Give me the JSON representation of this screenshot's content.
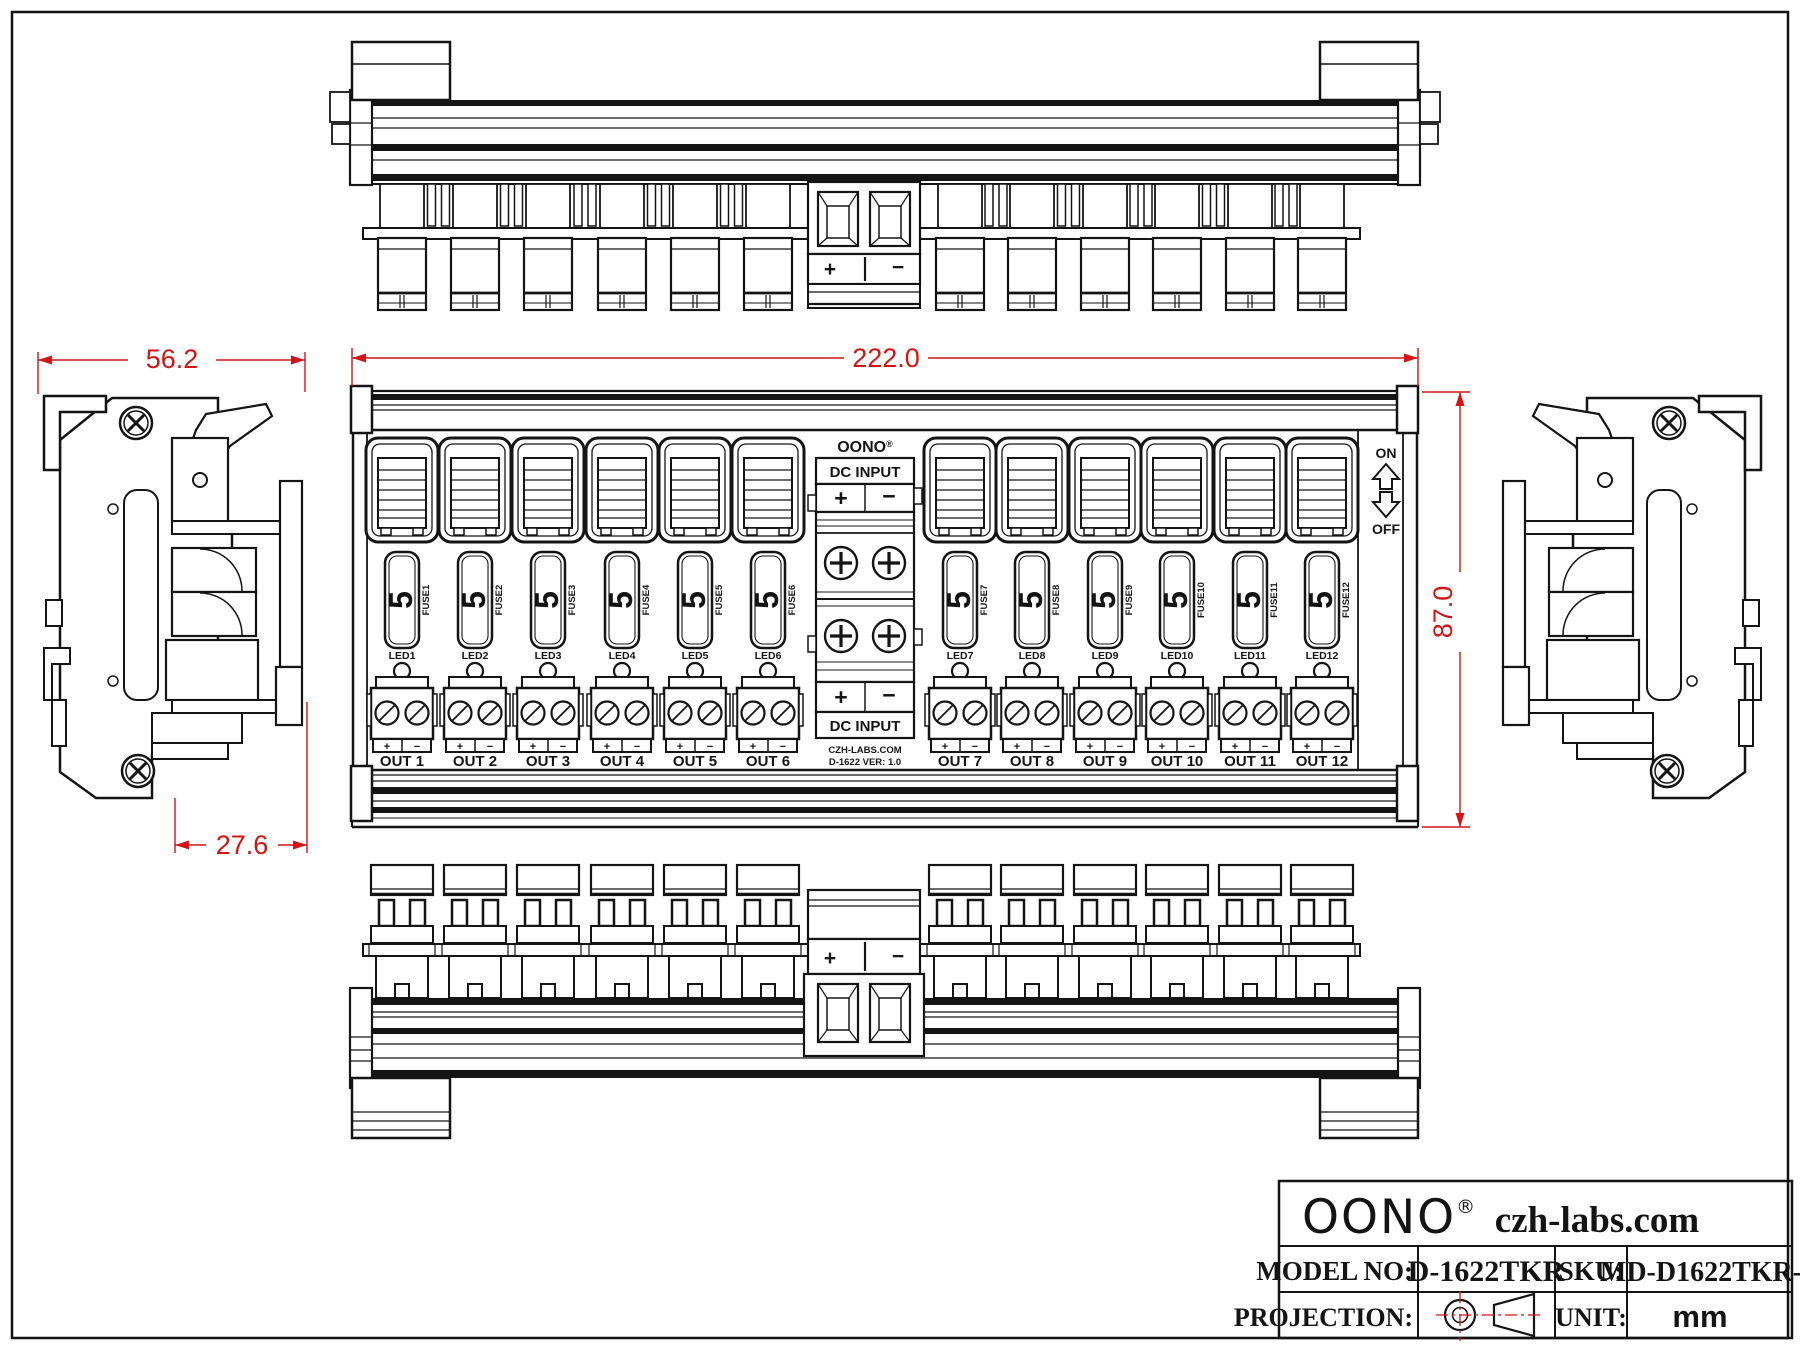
{
  "page": {
    "background": "#ffffff",
    "line_color": "#141414",
    "dimension_color": "#d31414"
  },
  "dimensions": {
    "overall_width": "222.0",
    "overall_height": "87.0",
    "side_width": "56.2",
    "side_depth": "27.6"
  },
  "views": {
    "top_view": {
      "input_plus": "+",
      "input_minus": "−"
    },
    "bottom_view": {
      "input_plus": "+",
      "input_minus": "−"
    },
    "front_view": {
      "brand": "OONO",
      "brand_reg": "®",
      "dc_input_label": "DC INPUT",
      "input_plus": "+",
      "input_minus": "−",
      "switch_on": "ON",
      "switch_off": "OFF",
      "footer_site": "CZH-LABS.COM",
      "footer_version": "D-1622  VER: 1.0",
      "fuse_rating": "5",
      "channels": [
        {
          "fuse": "FUSE1",
          "led": "LED1",
          "out": "OUT 1"
        },
        {
          "fuse": "FUSE2",
          "led": "LED2",
          "out": "OUT 2"
        },
        {
          "fuse": "FUSE3",
          "led": "LED3",
          "out": "OUT 3"
        },
        {
          "fuse": "FUSE4",
          "led": "LED4",
          "out": "OUT 4"
        },
        {
          "fuse": "FUSE5",
          "led": "LED5",
          "out": "OUT 5"
        },
        {
          "fuse": "FUSE6",
          "led": "LED6",
          "out": "OUT 6"
        },
        {
          "fuse": "FUSE7",
          "led": "LED7",
          "out": "OUT 7"
        },
        {
          "fuse": "FUSE8",
          "led": "LED8",
          "out": "OUT 8"
        },
        {
          "fuse": "FUSE9",
          "led": "LED9",
          "out": "OUT 9"
        },
        {
          "fuse": "FUSE10",
          "led": "LED10",
          "out": "OUT 10"
        },
        {
          "fuse": "FUSE11",
          "led": "LED11",
          "out": "OUT 11"
        },
        {
          "fuse": "FUSE12",
          "led": "LED12",
          "out": "OUT 12"
        }
      ]
    }
  },
  "title_block": {
    "brand": "OONO",
    "brand_reg": "®",
    "website": "czh-labs.com",
    "model_label": "MODEL NO:",
    "model_value": "D-1622TKR",
    "sku_label": "SKU:",
    "sku_value": "MD-D1622TKR-1",
    "projection_label": "PROJECTION:",
    "unit_label": "UNIT:",
    "unit_value": "mm"
  }
}
